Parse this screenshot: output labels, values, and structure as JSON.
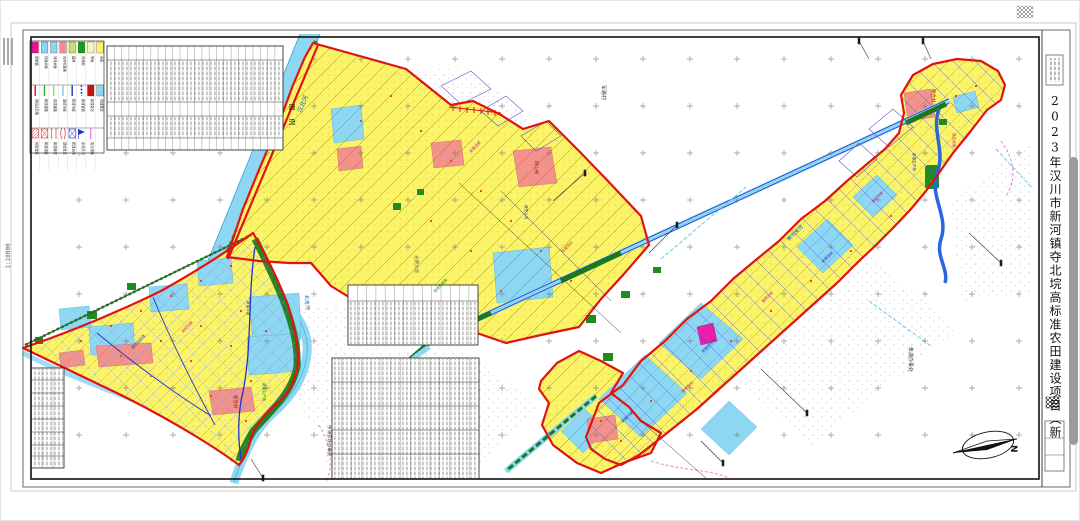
{
  "sheet": {
    "title": "2023年汉川市新河镇夺北垸高标准农田建设项目（新建）规划图",
    "scale_label": "1:10000",
    "legend_title": "图 例",
    "north_label": "N"
  },
  "legend": {
    "items": [
      {
        "row": 0,
        "label": "建制镇",
        "kind": "fill",
        "color": "#ee1289"
      },
      {
        "row": 0,
        "label": "坑塘水面",
        "kind": "fill",
        "color": "#8ed7f2"
      },
      {
        "row": 0,
        "label": "河流水面",
        "kind": "fill",
        "color": "#8ed7f2"
      },
      {
        "row": 0,
        "label": "农村宅基地",
        "kind": "fill",
        "color": "#f2928a"
      },
      {
        "row": 0,
        "label": "园地",
        "kind": "fill",
        "color": "#cadd6e"
      },
      {
        "row": 0,
        "label": "有林地",
        "kind": "fill",
        "color": "#13a113"
      },
      {
        "row": 0,
        "label": "旱地",
        "kind": "fill",
        "color": "#f7f7bb"
      },
      {
        "row": 0,
        "label": "水田",
        "kind": "fill",
        "color": "#fbf566"
      },
      {
        "row": 1,
        "label": "项目区范围",
        "kind": "line",
        "color": "#e01212"
      },
      {
        "row": 1,
        "label": "新建道路",
        "kind": "line",
        "color": "#2db52d"
      },
      {
        "row": 1,
        "label": "改建道路",
        "kind": "line",
        "color": "#7fe57f"
      },
      {
        "row": 1,
        "label": "现状沟渠",
        "kind": "line",
        "color": "#7fc8ee"
      },
      {
        "row": 1,
        "label": "新建沟渠",
        "kind": "line",
        "color": "#2233cc"
      },
      {
        "row": 1,
        "label": "新建管道",
        "kind": "dash",
        "color": "#2233cc"
      },
      {
        "row": 1,
        "label": "新建泵站",
        "kind": "sym-pump",
        "color": "#cc1111"
      },
      {
        "row": 1,
        "label": "坑塘整治",
        "kind": "fill",
        "color": "#8ed7f2"
      },
      {
        "row": 2,
        "label": "拆除建筑",
        "kind": "sym-hatch",
        "color": "#cc1111"
      },
      {
        "row": 2,
        "label": "新建涵管",
        "kind": "sym-x",
        "color": "#cc3333"
      },
      {
        "row": 2,
        "label": "新建桥梁",
        "kind": "sym-bridge",
        "color": "#cc3333"
      },
      {
        "row": 2,
        "label": "现状泵站",
        "kind": "sym-bracket",
        "color": "#cc3333"
      },
      {
        "row": 2,
        "label": "新建水闸",
        "kind": "sym-x",
        "color": "#2233cc"
      },
      {
        "row": 2,
        "label": "水流方向",
        "kind": "sym-flag",
        "color": "#2233cc"
      },
      {
        "row": 2,
        "label": "电力线路",
        "kind": "line",
        "color": "#ee82ee"
      }
    ]
  },
  "map": {
    "labels": [
      {
        "text": "汉北河",
        "x": 300,
        "y": 112,
        "rot": -67,
        "size": 6,
        "color": "#0b62a8"
      },
      {
        "text": "北支河",
        "x": 304,
        "y": 294,
        "rot": 86,
        "size": 5,
        "color": "#0b62a8"
      },
      {
        "text": "新沟支河",
        "x": 788,
        "y": 240,
        "rot": -44,
        "size": 5,
        "color": "#0b62a8"
      },
      {
        "text": "军路村",
        "x": 601,
        "y": 84,
        "rot": 90,
        "size": 5,
        "color": "#333333"
      },
      {
        "text": "朱湖办事处",
        "x": 908,
        "y": 346,
        "rot": 90,
        "size": 5,
        "color": "#333333"
      },
      {
        "text": "中洲农场办事处",
        "x": 327,
        "y": 424,
        "rot": 90,
        "size": 4.5,
        "color": "#333333"
      },
      {
        "text": "同心村",
        "x": 534,
        "y": 160,
        "rot": 90,
        "size": 4.5,
        "color": "#8a1a1a"
      },
      {
        "text": "新合村",
        "x": 233,
        "y": 394,
        "rot": 90,
        "size": 4.5,
        "color": "#8a1a1a"
      },
      {
        "text": "联合村",
        "x": 931,
        "y": 88,
        "rot": 90,
        "size": 4.5,
        "color": "#8a1a1a"
      },
      {
        "text": "光明大垸",
        "x": 414,
        "y": 254,
        "rot": 90,
        "size": 4.5,
        "color": "#555555"
      }
    ],
    "annotations": [
      {
        "text": "新建斗渠",
        "x": 246,
        "y": 300,
        "rot": 90,
        "color": "#2233cc"
      },
      {
        "text": "疏挖沟渠",
        "x": 182,
        "y": 332,
        "rot": -46,
        "color": "#cc10a0"
      },
      {
        "text": "整修田间道",
        "x": 132,
        "y": 348,
        "rot": -46,
        "color": "#2233cc"
      },
      {
        "text": "新建生产路",
        "x": 262,
        "y": 382,
        "rot": 90,
        "color": "#0a8a0a"
      },
      {
        "text": "新建涵管",
        "x": 470,
        "y": 152,
        "rot": -46,
        "color": "#cc10a0"
      },
      {
        "text": "疏挖斗沟",
        "x": 524,
        "y": 204,
        "rot": 90,
        "color": "#2233cc"
      },
      {
        "text": "新建泵站",
        "x": 562,
        "y": 252,
        "rot": -46,
        "color": "#cc3333"
      },
      {
        "text": "现状机耕路",
        "x": 434,
        "y": 292,
        "rot": -46,
        "color": "#0a8a0a"
      },
      {
        "text": "新建排水沟",
        "x": 702,
        "y": 352,
        "rot": -44,
        "color": "#2233cc"
      },
      {
        "text": "灌溉支渠",
        "x": 762,
        "y": 302,
        "rot": -44,
        "color": "#cc10a0"
      },
      {
        "text": "新建涵闸",
        "x": 822,
        "y": 262,
        "rot": -44,
        "color": "#2233cc"
      },
      {
        "text": "疏挖沟渠",
        "x": 872,
        "y": 202,
        "rot": -44,
        "color": "#cc10a0"
      },
      {
        "text": "新建生产桥",
        "x": 912,
        "y": 152,
        "rot": 90,
        "color": "#2233cc"
      },
      {
        "text": "低压线路",
        "x": 952,
        "y": 132,
        "rot": 90,
        "color": "#cc10a0"
      },
      {
        "text": "新建斗渠",
        "x": 622,
        "y": 422,
        "rot": -44,
        "color": "#2233cc"
      },
      {
        "text": "整修泵站",
        "x": 682,
        "y": 392,
        "rot": -44,
        "color": "#cc3333"
      }
    ]
  }
}
